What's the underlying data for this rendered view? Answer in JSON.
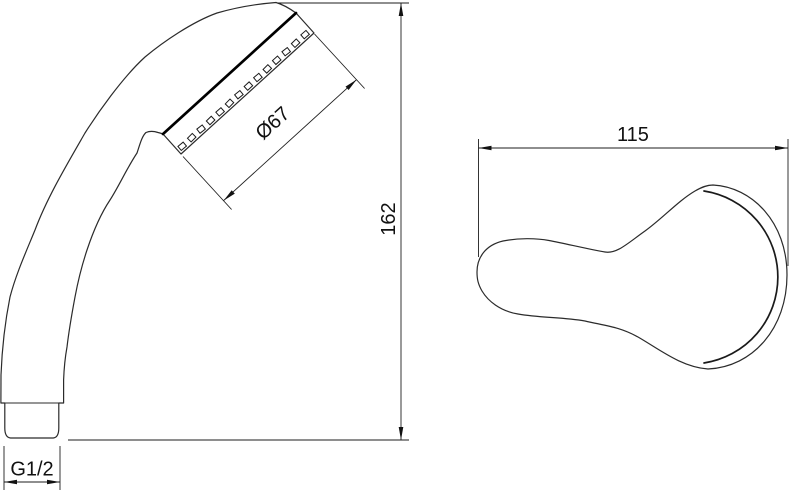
{
  "drawing": {
    "type": "technical-drawing",
    "subject": "hand-shower-head",
    "background_color": "#ffffff",
    "line_color": "#1e1e1e",
    "views": {
      "side_view": "shower-head-side-profile",
      "top_view": "shower-head-top-outline"
    }
  },
  "dimensions": {
    "face_diameter": "Ø67",
    "overall_height": "162",
    "head_width": "115",
    "thread_size": "G1/2"
  }
}
